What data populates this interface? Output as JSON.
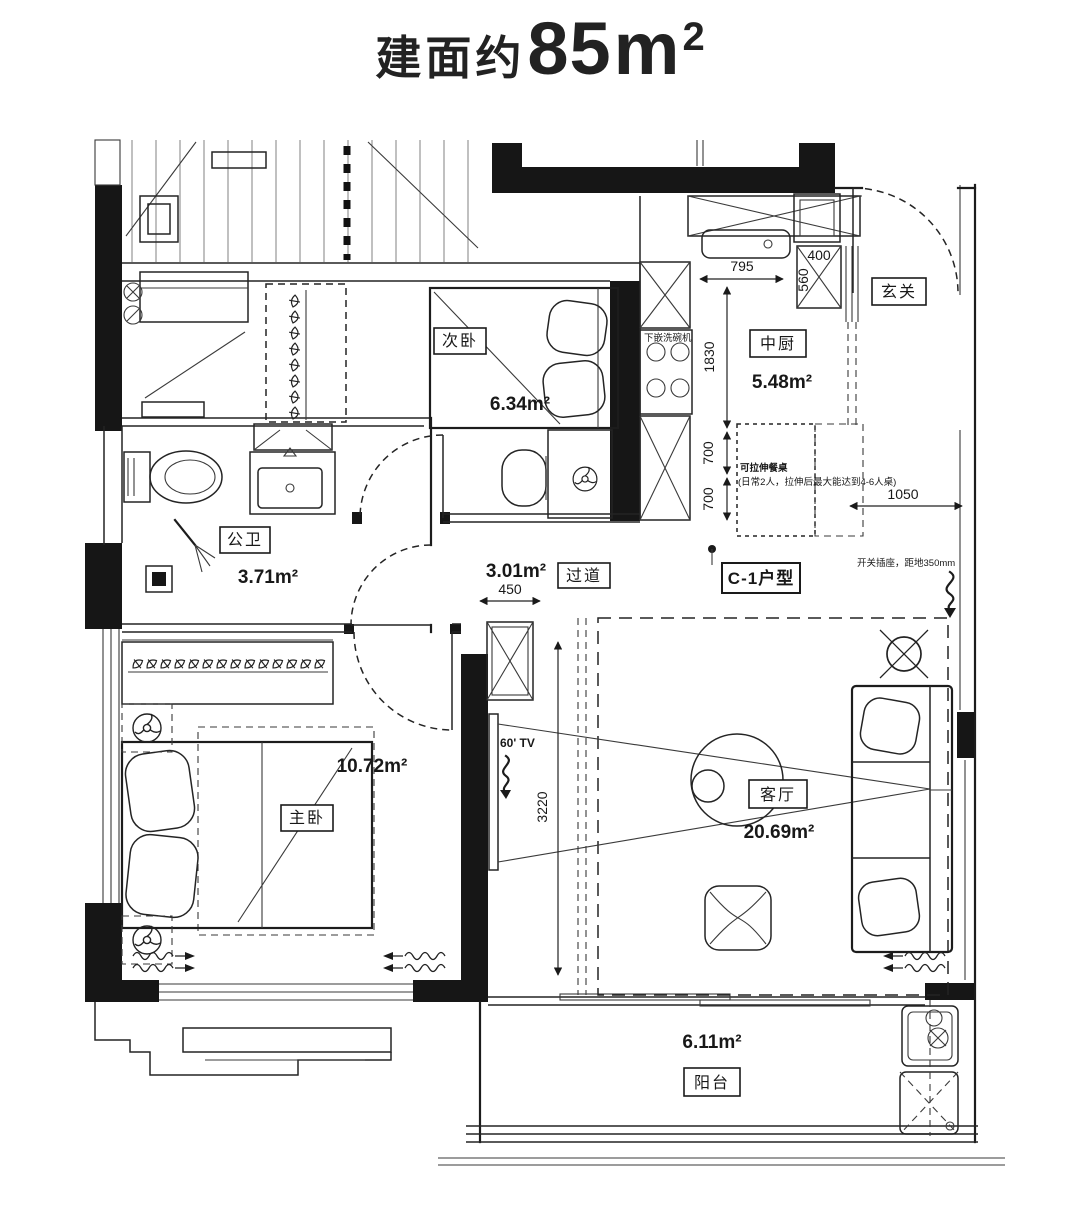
{
  "colors": {
    "ink": "#1a1a1a",
    "paper": "#ffffff"
  },
  "title": {
    "prefix": "建面约",
    "value": "85",
    "unit": "m",
    "sup": "2"
  },
  "unit_type": "C-1户型",
  "rooms": {
    "secondary_bedroom": {
      "label": "次卧",
      "area": "6.34m²"
    },
    "kitchen": {
      "label": "中厨",
      "area": "5.48m²"
    },
    "entry": {
      "label": "玄关"
    },
    "bathroom": {
      "label": "公卫",
      "area": "3.71m²"
    },
    "corridor": {
      "label": "过道",
      "area": "3.01m²"
    },
    "master_bedroom": {
      "label": "主卧",
      "area": "10.72m²"
    },
    "living_room": {
      "label": "客厅",
      "area": "20.69m²"
    },
    "balcony": {
      "label": "阳台",
      "area": "6.11m²"
    }
  },
  "dims": {
    "kitchen_width": "795",
    "kitchen_depth": "1830",
    "entry_cabinet_width": "400",
    "entry_cabinet_depth": "560",
    "table_gap_upper": "700",
    "table_gap_lower": "700",
    "entry_walk": "1050",
    "corridor_width": "450",
    "living_width": "3220"
  },
  "annotations": {
    "dishwasher": "下嵌洗碗机",
    "dining_title": "可拉伸餐桌",
    "dining_note": "(日常2人，拉伸后最大能达到4-6人桌)",
    "switch_note": "开关插座，距地350mm",
    "tv": "60' TV"
  }
}
